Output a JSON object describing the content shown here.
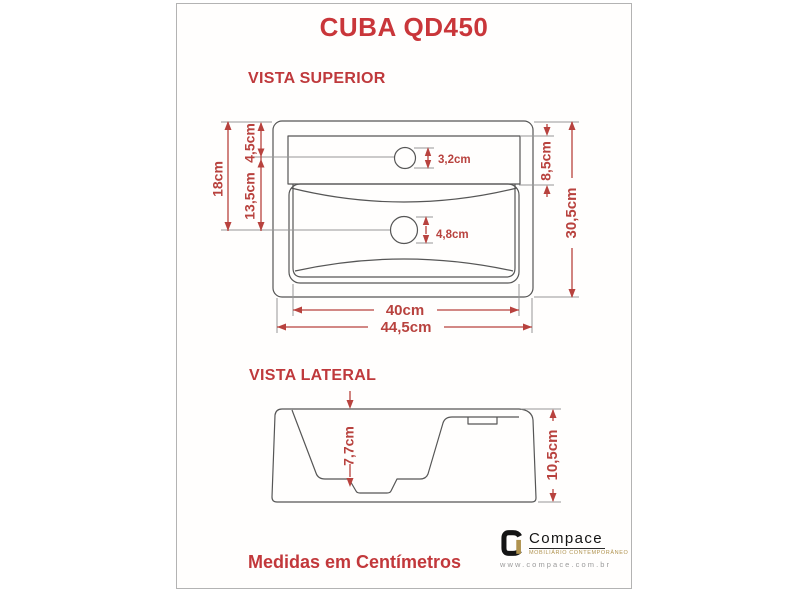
{
  "page": {
    "title": "CUBA QD450",
    "unit_note": "Medidas em Centímetros"
  },
  "top_view": {
    "label": "VISTA SUPERIOR",
    "dims": {
      "total_height_left": "18cm",
      "faucet_offset": "4,5cm",
      "faucet_to_drain": "13,5cm",
      "deck_depth": "8,5cm",
      "overall_depth": "30,5cm",
      "inner_width": "40cm",
      "overall_width": "44,5cm",
      "faucet_hole_diameter": "3,2cm",
      "drain_hole_diameter": "4,8cm"
    }
  },
  "side_view": {
    "label": "VISTA LATERAL",
    "dims": {
      "basin_depth": "7,7cm",
      "overall_height": "10,5cm"
    }
  },
  "branding": {
    "name": "Compace",
    "tagline": "MOBILIÁRIO CONTEMPORÂNEO",
    "website": "www.compace.com.br"
  },
  "colors": {
    "accent_red": "#c9363a",
    "line_gray": "#565656",
    "logo_gold": "#b0934f"
  }
}
